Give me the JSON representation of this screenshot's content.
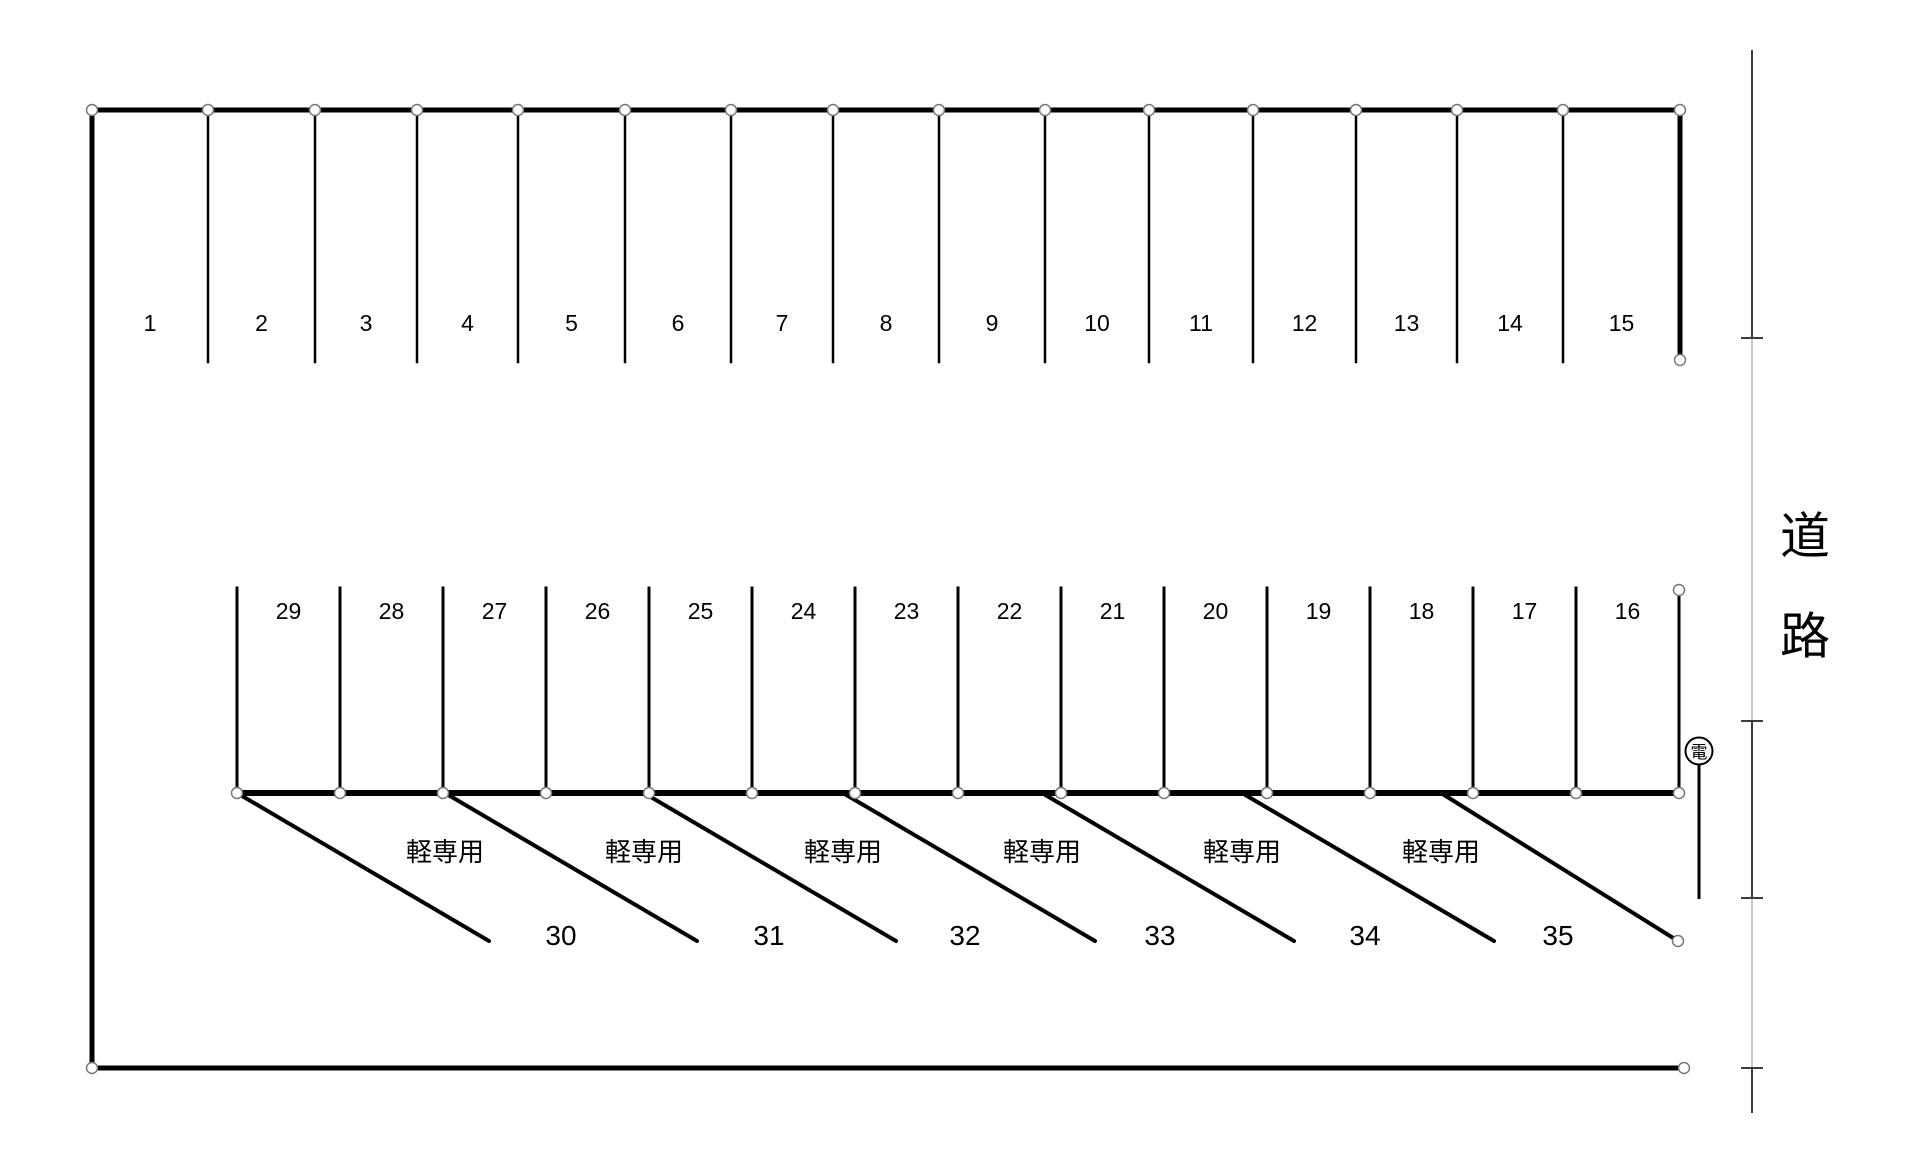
{
  "diagram": {
    "top_row_stalls": [
      "1",
      "2",
      "3",
      "4",
      "5",
      "6",
      "7",
      "8",
      "9",
      "10",
      "11",
      "12",
      "13",
      "14",
      "15"
    ],
    "middle_row_stalls": [
      "29",
      "28",
      "27",
      "26",
      "25",
      "24",
      "23",
      "22",
      "21",
      "20",
      "19",
      "18",
      "17",
      "16"
    ],
    "kei_row": {
      "stall_numbers": [
        "30",
        "31",
        "32",
        "33",
        "34",
        "35"
      ],
      "stall_type_label": "軽専用"
    },
    "road_label": "道路",
    "utility_pole_label": "電"
  },
  "colors": {
    "background": "#ffffff",
    "line": "#000000",
    "road_line_dark": "#3c3c3c",
    "road_line_light": "#c9c9c9",
    "node_fill": "#ffffff",
    "node_stroke": "#777777"
  }
}
